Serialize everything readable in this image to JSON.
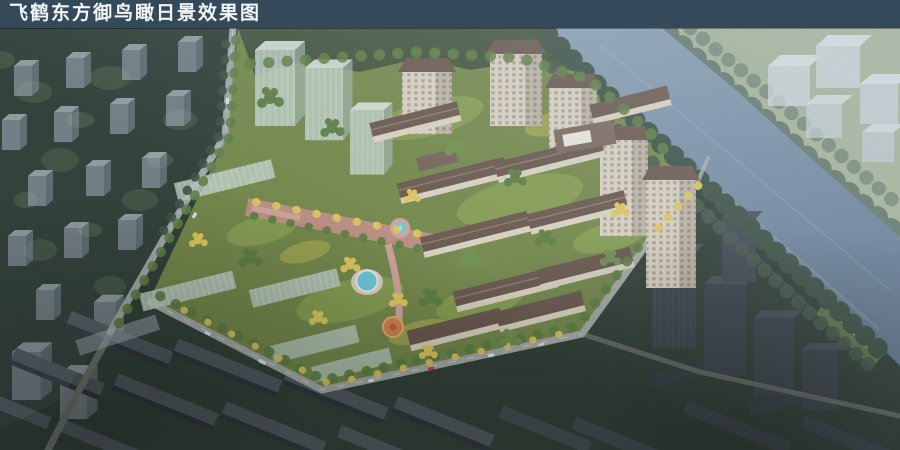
{
  "header": {
    "title": "飞鹤东方御鸟瞰日景效果图"
  },
  "scene": {
    "description": "Aerial daytime rendering of the Feihe Dongfang Yu residential development: detailed tan mid-rise slabs and high-rise towers with brown roofs around a landscaped central axis with round pool, surrounded by translucent massing blocks, dark context housing rows, forests and a river crossing the upper right corner.",
    "palette": {
      "title_bar": "#34495A",
      "title_text": "#F2F5F7",
      "water": "#8AA0B5",
      "water_deep": "#667C93",
      "far_bank": "#A3B296",
      "far_trees": "#5F7465",
      "near_trees": "#3E5246",
      "forest": "#33423A",
      "forest_dark": "#29372E",
      "site_lawn": "#74894C",
      "lawn_bright": "#93AE59",
      "tree_green": "#5E7F44",
      "tree_yellow": "#DCC65E",
      "roof_brown": "#6A594F",
      "facade": "#D9D1C1",
      "ghost_blue": "#AFBCC9",
      "ghost_glass": "#B8CABF",
      "road": "#A6ABA8",
      "plaza": "#C08F87",
      "pool": "#6FC6DA",
      "playground": "#CE8350",
      "context_slab": "#525A61",
      "dark_tower": "#3D454D",
      "car_red": "#C04038"
    }
  }
}
